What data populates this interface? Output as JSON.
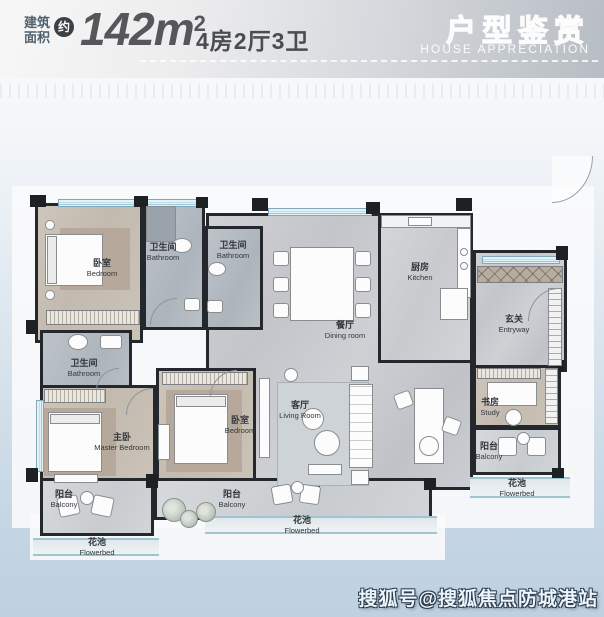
{
  "header": {
    "area_label_top": "建筑",
    "area_label_bottom": "面积",
    "approx": "约",
    "area_number": "142",
    "area_unit": "m",
    "area_sup": "2",
    "spec": "4房2厅3卫",
    "title_cn": "户型鉴赏",
    "title_en": "HOUSE APPRECIATION"
  },
  "rooms": [
    {
      "cn": "卧室",
      "en": "Bedroom"
    },
    {
      "cn": "卫生间",
      "en": "Bathroom"
    },
    {
      "cn": "卫生间",
      "en": "Bathroom"
    },
    {
      "cn": "餐厅",
      "en": "Dining room"
    },
    {
      "cn": "厨房",
      "en": "Kitchen"
    },
    {
      "cn": "玄关",
      "en": "Entryway"
    },
    {
      "cn": "卫生间",
      "en": "Bathroom"
    },
    {
      "cn": "主卧",
      "en": "Master Bedroom"
    },
    {
      "cn": "卧室",
      "en": "Bedroom"
    },
    {
      "cn": "客厅",
      "en": "Living Room"
    },
    {
      "cn": "书房",
      "en": "Study"
    },
    {
      "cn": "阳台",
      "en": "Balcony"
    },
    {
      "cn": "花池",
      "en": "Flowerbed"
    },
    {
      "cn": "阳台",
      "en": "Balcony"
    },
    {
      "cn": "花池",
      "en": "Flowerbed"
    },
    {
      "cn": "阳台",
      "en": "Balcony"
    },
    {
      "cn": "花池",
      "en": "Flowerbed"
    }
  ],
  "watermark": "搜狐号@搜狐焦点防城港站",
  "colors": {
    "wall": "#24272b",
    "floor_warm": "#c9c0b4",
    "floor_marble": "#c8cace",
    "floor_bath": "#b6bdc4",
    "window_blue": "#9dc9d8",
    "page_blue": "#c3d4e3",
    "badge_dark": "#3c4043",
    "header_text": "#55575a"
  }
}
